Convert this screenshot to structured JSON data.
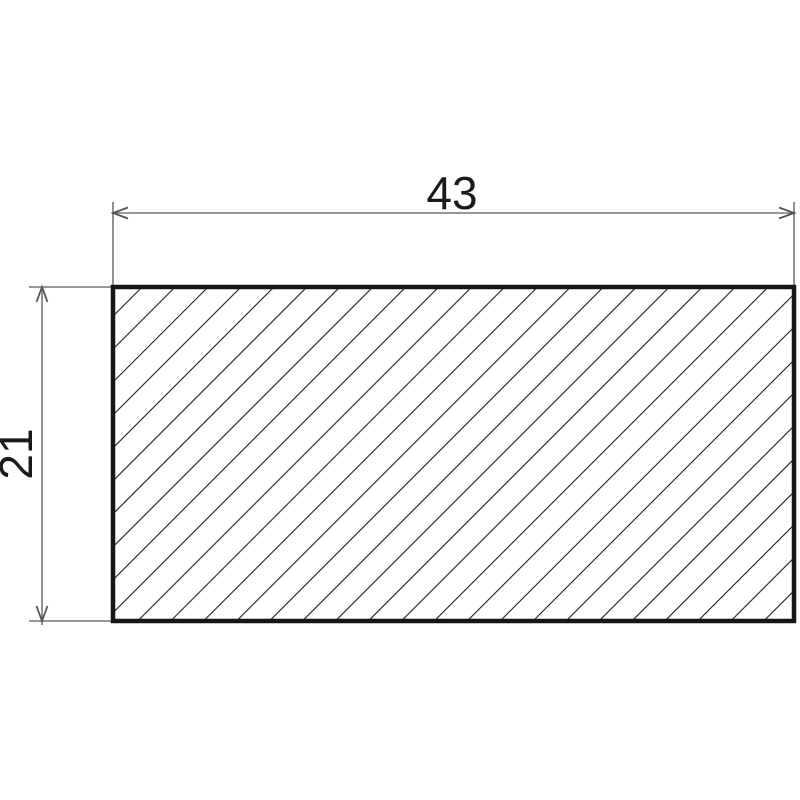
{
  "drawing": {
    "type": "technical-section-drawing",
    "dimension_width": {
      "value": "43",
      "orientation": "horizontal"
    },
    "dimension_height": {
      "value": "21",
      "orientation": "vertical-rotated"
    },
    "hatch": {
      "style": "diagonal-45",
      "direction": "/"
    },
    "colors": {
      "background": "#ffffff",
      "outline": "#161616",
      "hatch_line": "#1d1d1d",
      "dimension_line": "#767676",
      "arrow": "#555555",
      "label_text": "#1a1a1a"
    }
  }
}
